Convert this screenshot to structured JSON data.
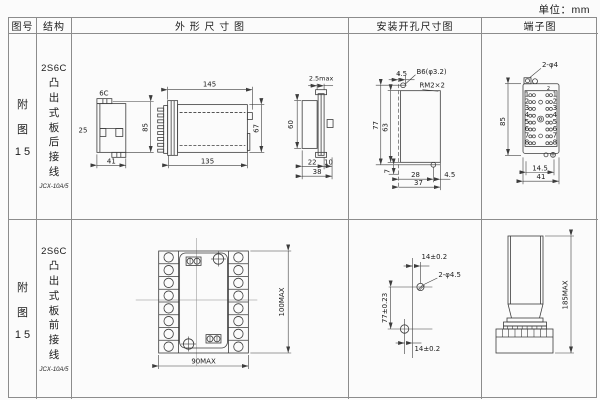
{
  "unit_label": "单位：mm",
  "header": {
    "figure": "图号",
    "structure": "结构",
    "outline": "外 形 尺 寸 图",
    "mounting": "安装开孔尺寸图",
    "terminal": "端子图"
  },
  "rows": [
    {
      "figure": {
        "char1": "附",
        "char2": "图",
        "num": "1 5"
      },
      "structure": {
        "model": "2S6C",
        "desc": "凸出式板后接线",
        "code": "JCX-10A/5"
      },
      "outline": {
        "v1_top": "6C",
        "v1_left": "25",
        "v1_right": "85",
        "v1_bottom": "41",
        "v2_top": "145",
        "v2_bottom": "135",
        "v2_right": "67",
        "v3_top": "2.5max",
        "v3_left": "60",
        "v3_b1": "22",
        "v3_b2": "10",
        "v3_b3": "38"
      },
      "mounting": {
        "top_offset": "4.5",
        "hole_label": "B6(φ3.2)",
        "thread_label": "RM2×2",
        "height_outer": "77",
        "height_inner": "63",
        "bottom_left": "7",
        "bottom_span": "28",
        "bottom_right": "4.5",
        "bottom_total": "37"
      },
      "terminal": {
        "hole_label": "2-φ4",
        "corner_label": "2",
        "height": "85",
        "bottom_inner": "14.5",
        "bottom_total": "41",
        "pin_numbers": [
          "1",
          "2",
          "3",
          "4",
          "5",
          "6",
          "7",
          "8"
        ]
      }
    },
    {
      "figure": {
        "char1": "附",
        "char2": "图",
        "num": "1 5"
      },
      "structure": {
        "model": "2S6C",
        "desc": "凸出式板前接线",
        "code": "JCX-10A/5"
      },
      "outline": {
        "height": "100MAX",
        "width": "90MAX"
      },
      "mounting": {
        "top_offset": "14±0.2",
        "hole_label": "2-φ4.5",
        "height": "77±0.23",
        "bottom_offset": "14±0.2"
      },
      "terminal": {
        "height": "185MAX"
      }
    }
  ]
}
